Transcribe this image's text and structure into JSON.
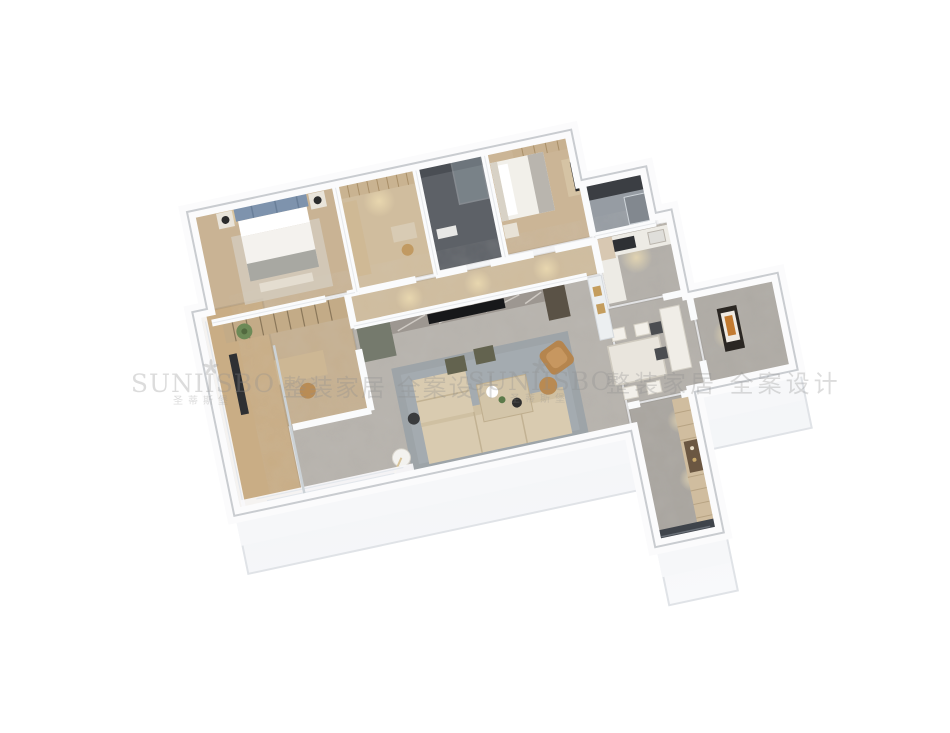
{
  "scene": {
    "type": "3d-floorplan-dollhouse-render",
    "background": "#ffffff",
    "view": "axonometric top-down, rotated ~12 degrees"
  },
  "watermark": {
    "brand": "SUNIISBO",
    "brand_cn": "圣蒂斯堡",
    "tagline": "整装家居 全案设计",
    "color": "#8f8f8f",
    "flower_icon": "brand-flower-icon"
  },
  "palette": {
    "exterior_face": "#f4f5f7",
    "wall_top": "#fbfbfc",
    "marble_floor": "#b6b2ac",
    "wood_floor": "#c9b394",
    "corridor_wood": "#cfbc9d",
    "balcony_wood": "#c9ad85",
    "bath_dark_walls": "#5d6167",
    "bath_gray": "#969ca3",
    "sofa_beige": "#d9cbb0",
    "accent_chair_caramel": "#b5854e",
    "rug_bluegray": "#99a1a7",
    "tv_wall_marble": "#9d9791",
    "tv_cabinet_olive": "#757a6d",
    "kitchen_counter": "#edebe5",
    "entry_wardrobe": "#d0bd9f",
    "entry_door": "#3f444b",
    "bed_headboard_blue": "#7e93ad",
    "bedding_white": "#f4f2ee",
    "art_amber": "#c27a30"
  },
  "rooms": [
    {
      "name": "master-bedroom"
    },
    {
      "name": "walk-in-closet"
    },
    {
      "name": "dark-bathroom"
    },
    {
      "name": "second-bedroom"
    },
    {
      "name": "gray-bathroom"
    },
    {
      "name": "kitchen"
    },
    {
      "name": "dining-area"
    },
    {
      "name": "entry-foyer"
    },
    {
      "name": "entry-corridor"
    },
    {
      "name": "living-room"
    },
    {
      "name": "study"
    },
    {
      "name": "balcony"
    },
    {
      "name": "hallway"
    }
  ]
}
